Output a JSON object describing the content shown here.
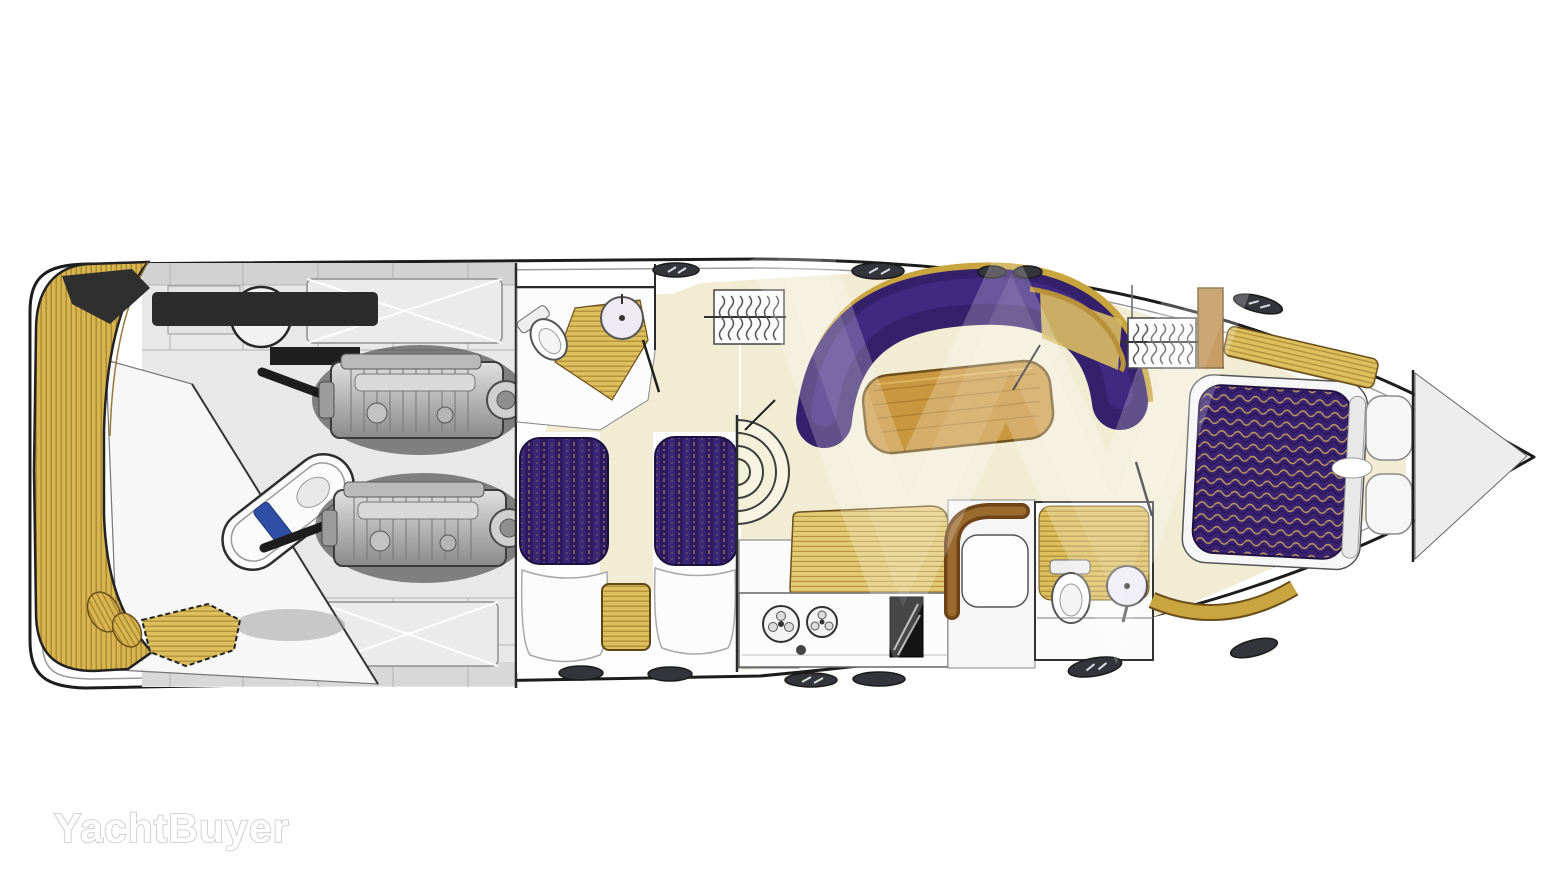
{
  "watermark": {
    "brand": "YachtBuyer"
  },
  "palette": {
    "hull_outline": "#1c1c1c",
    "teak": "#d8b54f",
    "teak_stripe": "#a5842f",
    "floor_cream": "#f2ecd4",
    "upholstery_purple": "#34206b",
    "upholstery_highlight": "#4a3190",
    "berth_purple": "#2d1a60",
    "wood_table": "#c9973f",
    "settee_wood": "#8a5a26",
    "tender_accent_blue": "#2e4fa5",
    "ghost_deck_gray": "#e8e8e8",
    "hatch_gray": "#34343c"
  },
  "diagram": {
    "type": "yacht-deck-plan",
    "view": "overhead-cutaway-floor-plan",
    "orientation": "bow-right",
    "regions": [
      {
        "id": "swim-platform",
        "label": "teak swim platform"
      },
      {
        "id": "tender-garage",
        "label": "tender garage with dinghy"
      },
      {
        "id": "aft-deck",
        "label": "aft cockpit deck (ghosted) with round table and sunpads"
      },
      {
        "id": "engine-room",
        "label": "twin engine room"
      },
      {
        "id": "aft-head",
        "label": "aft bathroom with toilet and basin"
      },
      {
        "id": "twin-cabin",
        "label": "twin guest cabin with two berths and nightstand"
      },
      {
        "id": "companionway",
        "label": "curved companionway stairs"
      },
      {
        "id": "salon",
        "label": "salon with curved sofa and wood table"
      },
      {
        "id": "galley",
        "label": "galley with two burners, oven and sink"
      },
      {
        "id": "dinette",
        "label": "curved settee with table"
      },
      {
        "id": "forward-head",
        "label": "forward bathroom with toilet and basin"
      },
      {
        "id": "master-cabin",
        "label": "master cabin with island berth, wardrobe and vanity"
      },
      {
        "id": "bow-locker",
        "label": "forepeak anchor locker"
      }
    ]
  }
}
